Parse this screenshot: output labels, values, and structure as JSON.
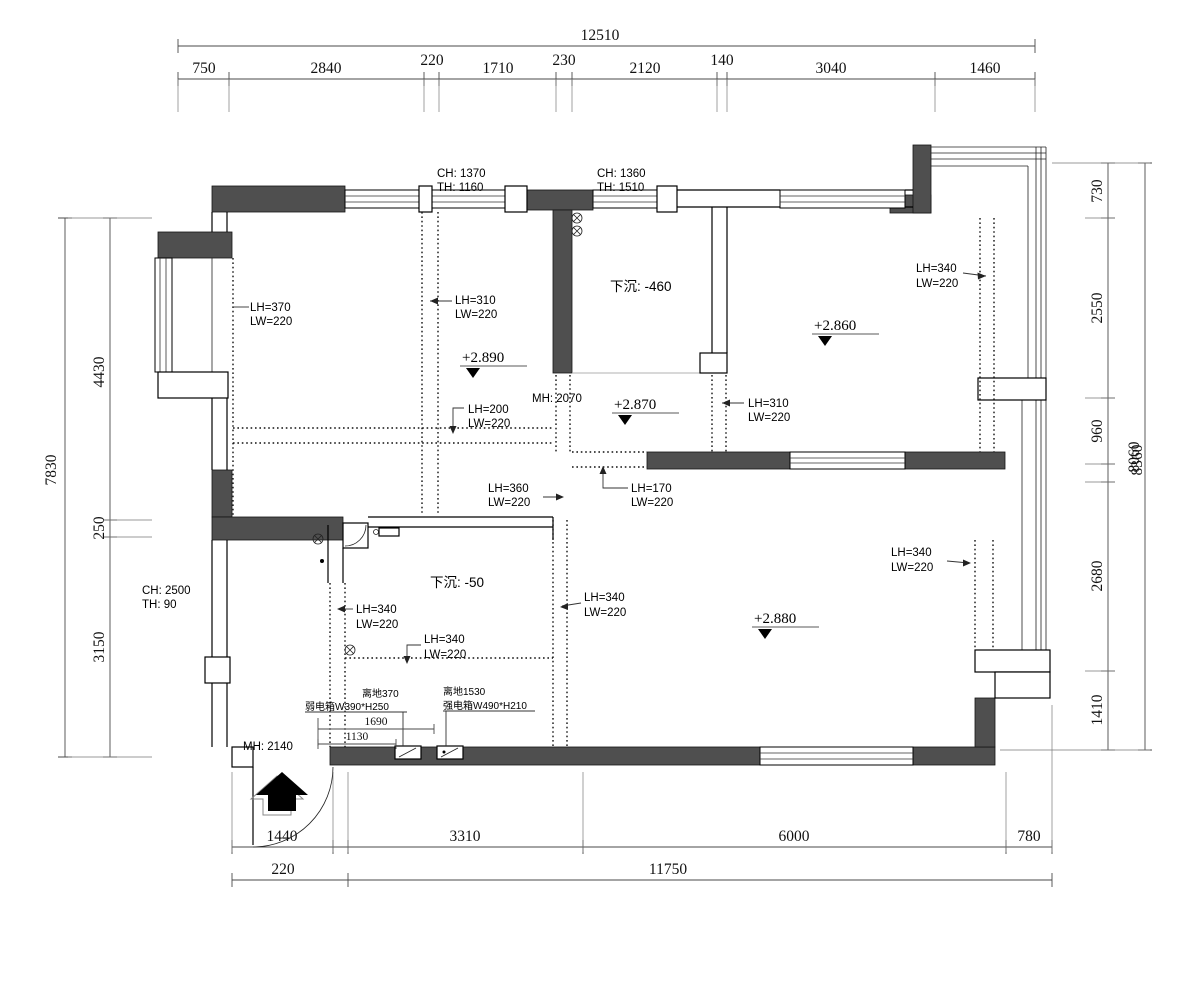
{
  "drawing": {
    "type": "floor-plan",
    "units": "mm"
  },
  "colors": {
    "background": "#ffffff",
    "wall_fill": "#4f4f4f",
    "line": "#000000",
    "dim_line": "#4a4a4a"
  },
  "dimensions": {
    "top": {
      "total": "12510",
      "segments": [
        "750",
        "2840",
        "220",
        "1710",
        "230",
        "2120",
        "140",
        "3040",
        "1460"
      ]
    },
    "left": {
      "total": "7830",
      "segments": [
        "4430",
        "250",
        "3150"
      ]
    },
    "right": {
      "total": "8060",
      "total_overlap": "8360",
      "segments": [
        "730",
        "2550",
        "960",
        "2680",
        "1410"
      ]
    },
    "bottom": {
      "row1": [
        "1440",
        "3310",
        "6000",
        "780"
      ],
      "row2": [
        "220",
        "11750"
      ]
    },
    "interior": {
      "box_span": "1690",
      "box_span_inner": "1130"
    }
  },
  "annotations": {
    "window1": {
      "ch": "CH: 1370",
      "th": "TH: 1160"
    },
    "window2": {
      "ch": "CH: 1360",
      "th": "TH: 1510"
    },
    "left_wall": {
      "ch": "CH: 2500",
      "th": "TH: 90"
    },
    "door_mid": {
      "mh": "MH: 2070"
    },
    "entry": {
      "mh": "MH: 2140"
    },
    "sunken_large": "下沉: -460",
    "sunken_small": "下沉: -50"
  },
  "elevations": [
    "+2.890",
    "+2.870",
    "+2.860",
    "+2.880"
  ],
  "beams": [
    {
      "lh": "LH=370",
      "lw": "LW=220"
    },
    {
      "lh": "LH=310",
      "lw": "LW=220"
    },
    {
      "lh": "LH=340",
      "lw": "LW=220"
    },
    {
      "lh": "LH=310",
      "lw": "LW=220"
    },
    {
      "lh": "LH=200",
      "lw": "LW=220"
    },
    {
      "lh": "LH=360",
      "lw": "LW=220"
    },
    {
      "lh": "LH=170",
      "lw": "LW=220"
    },
    {
      "lh": "LH=340",
      "lw": "LW=220"
    },
    {
      "lh": "LH=340",
      "lw": "LW=220"
    },
    {
      "lh": "LH=340",
      "lw": "LW=220"
    },
    {
      "lh": "LH=340",
      "lw": "LW=220"
    }
  ],
  "electrical": {
    "weak_box": {
      "height": "离地370",
      "size": "弱电箱W390*H250"
    },
    "strong_box": {
      "height": "离地1530",
      "size": "强电箱W490*H210"
    }
  }
}
